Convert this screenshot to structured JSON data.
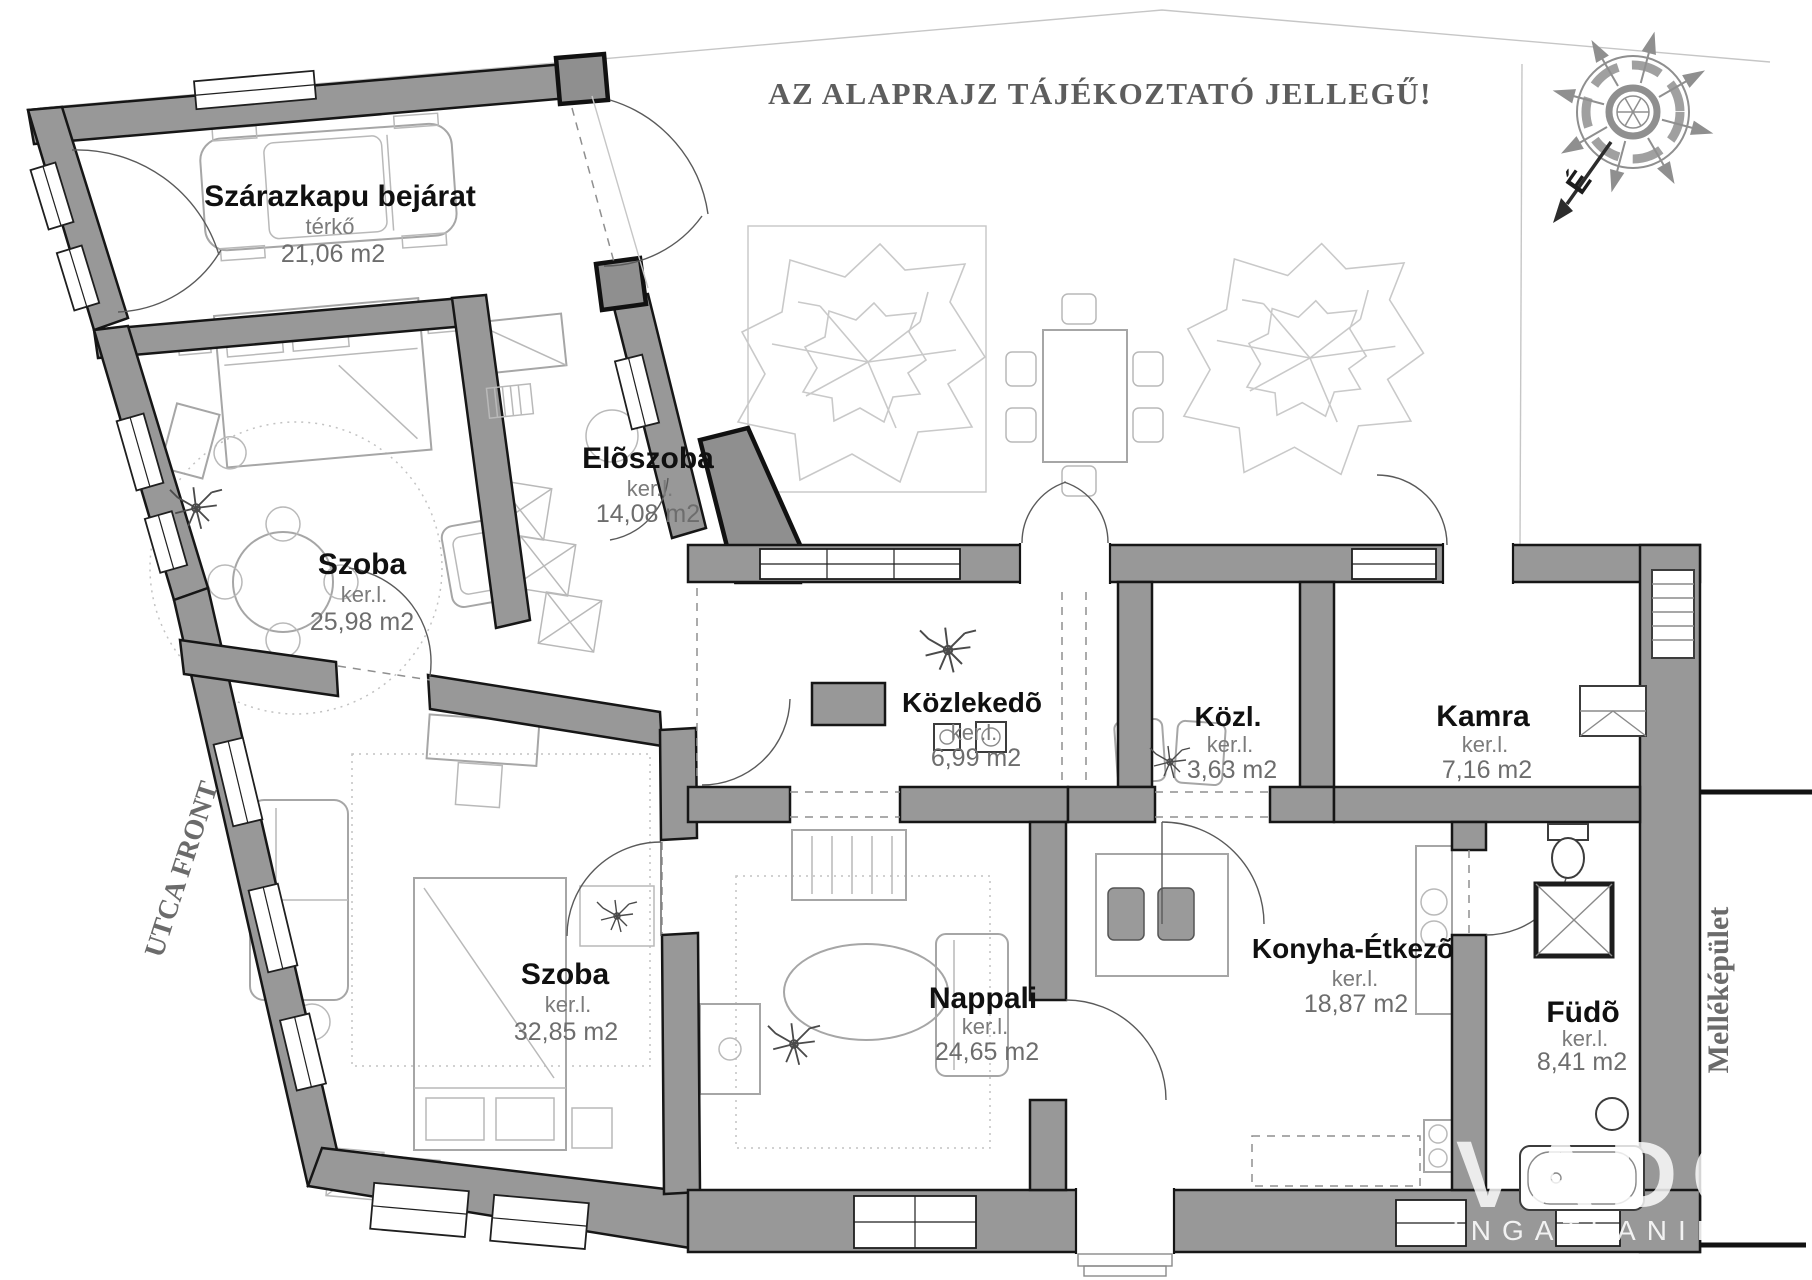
{
  "header": {
    "disclaimer": "AZ ALAPRAJZ TÁJÉKOZTATÓ JELLEGŰ!"
  },
  "site_labels": {
    "street_front": "UTCA FRONT",
    "outbuilding": "Melléképület"
  },
  "compass": {
    "north_letter": "É"
  },
  "watermark": {
    "logo": "VADO",
    "subtext": "INGATLANIR"
  },
  "rooms": [
    {
      "name": "Szárazkapu bejárat",
      "finish": "térkő",
      "area": "21,06 m2"
    },
    {
      "name": "Szoba",
      "finish": "ker.l.",
      "area": "25,98 m2"
    },
    {
      "name": "Elõszoba",
      "finish": "ker.l.",
      "area": "14,08 m2"
    },
    {
      "name": "Közlekedõ",
      "finish": "ker.l.",
      "area": "6,99 m2"
    },
    {
      "name": "Közl.",
      "finish": "ker.l.",
      "area": "3,63 m2"
    },
    {
      "name": "Kamra",
      "finish": "ker.l.",
      "area": "7,16 m2"
    },
    {
      "name": "Szoba",
      "finish": "ker.l.",
      "area": "32,85 m2"
    },
    {
      "name": "Nappali",
      "finish": "ker.l.",
      "area": "24,65 m2"
    },
    {
      "name": "Konyha-Étkezõ",
      "finish": "ker.l.",
      "area": "18,87 m2"
    },
    {
      "name": "Füdõ",
      "finish": "ker.l.",
      "area": "8,41 m2"
    }
  ],
  "colors": {
    "wall": "#989898",
    "wall_outline": "#161616",
    "furniture_line": "#a6a6a6",
    "tree_line": "#c9c9c9",
    "room_name_text": "#101010",
    "secondary_text": "#7b7b7b",
    "header_text": "#5d5d5d",
    "watermark": "#ffffff"
  }
}
